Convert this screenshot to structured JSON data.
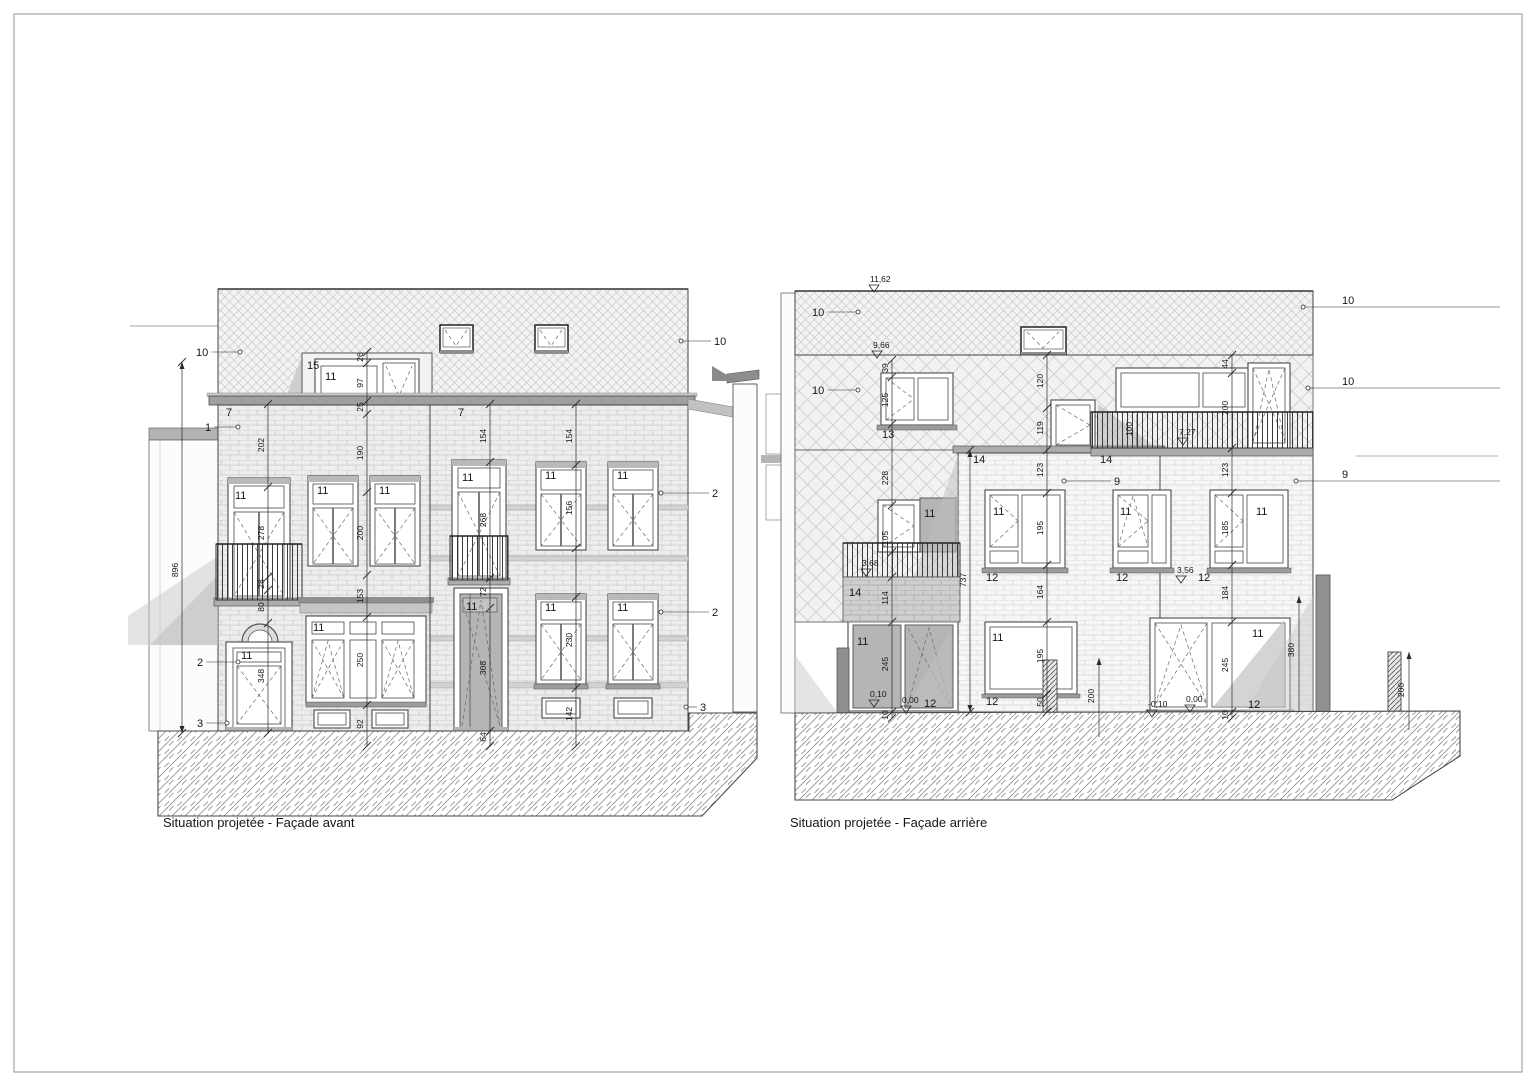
{
  "titles": {
    "front": "Situation projetée - Façade avant",
    "rear": "Situation projetée - Façade arrière"
  },
  "colors": {
    "ink": "#1a1a1a",
    "wall": "#ededed",
    "glass_tinted": "#b5b5b5",
    "shadow": "#c6c6c6"
  },
  "front": {
    "callouts": [
      {
        "t": "10",
        "tx": 196,
        "ty": 349,
        "dx": 240,
        "dy": 352
      },
      {
        "t": "10",
        "tx": 714,
        "ty": 337,
        "dx": 681,
        "dy": 341
      },
      {
        "t": "1",
        "tx": 205,
        "ty": 424,
        "dx": 238,
        "dy": 427
      },
      {
        "t": "2",
        "tx": 197,
        "ty": 659,
        "dx": 238,
        "dy": 662
      },
      {
        "t": "3",
        "tx": 197,
        "ty": 720,
        "dx": 227,
        "dy": 723
      },
      {
        "t": "2",
        "tx": 712,
        "ty": 489,
        "dx": 661,
        "dy": 493
      },
      {
        "t": "2",
        "tx": 712,
        "ty": 608,
        "dx": 661,
        "dy": 612
      },
      {
        "t": "3",
        "tx": 700,
        "ty": 703,
        "dx": 686,
        "dy": 707
      }
    ],
    "labels": [
      {
        "t": "7",
        "x": 226,
        "y": 416
      },
      {
        "t": "7",
        "x": 458,
        "y": 416
      },
      {
        "t": "15",
        "x": 307,
        "y": 369
      },
      {
        "t": "11",
        "x": 325,
        "y": 380
      },
      {
        "t": "11",
        "x": 235,
        "y": 499
      },
      {
        "t": "11",
        "x": 317,
        "y": 494
      },
      {
        "t": "11",
        "x": 379,
        "y": 494
      },
      {
        "t": "11",
        "x": 313,
        "y": 631
      },
      {
        "t": "11",
        "x": 241,
        "y": 659
      },
      {
        "t": "11",
        "x": 462,
        "y": 481
      },
      {
        "t": "11",
        "x": 466,
        "y": 610
      },
      {
        "t": "11",
        "x": 545,
        "y": 479
      },
      {
        "t": "11",
        "x": 617,
        "y": 479
      },
      {
        "t": "11",
        "x": 545,
        "y": 611
      },
      {
        "t": "11",
        "x": 617,
        "y": 611
      }
    ],
    "chains": [
      {
        "x": 182,
        "y1": 362,
        "y2": 733,
        "arrow": true,
        "ticks": [
          362,
          733
        ],
        "labels": [
          {
            "t": "896",
            "y": 570
          }
        ]
      },
      {
        "x": 268,
        "y1": 404,
        "y2": 733,
        "ticks": [
          404,
          487,
          577,
          590,
          623,
          733
        ],
        "labels": [
          {
            "t": "202",
            "y": 445
          },
          {
            "t": "278",
            "y": 533
          },
          {
            "t": "28",
            "y": 584
          },
          {
            "t": "80",
            "y": 607
          },
          {
            "t": "348",
            "y": 676
          }
        ]
      },
      {
        "x": 367,
        "y1": 352,
        "y2": 746,
        "ticks": [
          352,
          363,
          401,
          414,
          492,
          575,
          617,
          705,
          746
        ],
        "labels": [
          {
            "t": "26",
            "y": 357
          },
          {
            "t": "97",
            "y": 383
          },
          {
            "t": "25",
            "y": 407
          },
          {
            "t": "190",
            "y": 453
          },
          {
            "t": "200",
            "y": 533
          },
          {
            "t": "153",
            "y": 596
          },
          {
            "t": "250",
            "y": 660
          },
          {
            "t": "92",
            "y": 724
          }
        ]
      },
      {
        "x": 490,
        "y1": 404,
        "y2": 746,
        "ticks": [
          404,
          462,
          578,
          608,
          731,
          746
        ],
        "labels": [
          {
            "t": "154",
            "y": 436
          },
          {
            "t": "268",
            "y": 520
          },
          {
            "t": "72",
            "y": 592
          },
          {
            "t": "308",
            "y": 668
          },
          {
            "t": "64",
            "y": 737
          }
        ]
      },
      {
        "x": 576,
        "y1": 404,
        "y2": 746,
        "ticks": [
          404,
          465,
          548,
          597,
          688,
          746
        ],
        "labels": [
          {
            "t": "154",
            "y": 436
          },
          {
            "t": "156",
            "y": 508
          },
          {
            "t": "230",
            "y": 640
          },
          {
            "t": "142",
            "y": 714
          }
        ]
      }
    ]
  },
  "rear": {
    "callouts": [
      {
        "t": "10",
        "tx": 812,
        "ty": 308,
        "dx": 858,
        "dy": 312
      },
      {
        "t": "10",
        "tx": 812,
        "ty": 386,
        "dx": 858,
        "dy": 390
      },
      {
        "t": "10",
        "tx": 1342,
        "ty": 303,
        "dx": 1303,
        "dy": 307,
        "ext": 1500
      },
      {
        "t": "10",
        "tx": 1342,
        "ty": 384,
        "dx": 1308,
        "dy": 388,
        "ext": 1500
      },
      {
        "t": "9",
        "tx": 1114,
        "ty": 477,
        "dx": 1064,
        "dy": 481
      },
      {
        "t": "9",
        "tx": 1342,
        "ty": 477,
        "dx": 1296,
        "dy": 481,
        "ext": 1500
      }
    ],
    "labels": [
      {
        "t": "13",
        "x": 882,
        "y": 438
      },
      {
        "t": "14",
        "x": 973,
        "y": 463
      },
      {
        "t": "14",
        "x": 1100,
        "y": 463
      },
      {
        "t": "14",
        "x": 849,
        "y": 596
      },
      {
        "t": "11",
        "x": 924,
        "y": 517
      },
      {
        "t": "11",
        "x": 993,
        "y": 515
      },
      {
        "t": "11",
        "x": 992,
        "y": 641
      },
      {
        "t": "11",
        "x": 857,
        "y": 645
      },
      {
        "t": "11",
        "x": 1120,
        "y": 515
      },
      {
        "t": "11",
        "x": 1256,
        "y": 515
      },
      {
        "t": "11",
        "x": 1252,
        "y": 637
      },
      {
        "t": "12",
        "x": 986,
        "y": 581
      },
      {
        "t": "12",
        "x": 1116,
        "y": 581
      },
      {
        "t": "12",
        "x": 1198,
        "y": 581
      },
      {
        "t": "12",
        "x": 924,
        "y": 707
      },
      {
        "t": "12",
        "x": 986,
        "y": 705
      },
      {
        "t": "12",
        "x": 1248,
        "y": 708
      }
    ],
    "levels": [
      {
        "t": "11,62",
        "x": 874,
        "y": 285
      },
      {
        "t": "9,66",
        "x": 877,
        "y": 351
      },
      {
        "t": "7,27",
        "x": 1183,
        "y": 438
      },
      {
        "t": "3,68",
        "x": 866,
        "y": 569
      },
      {
        "t": "3,56",
        "x": 1181,
        "y": 576
      },
      {
        "t": "0,10",
        "x": 874,
        "y": 700
      },
      {
        "t": "0,00",
        "x": 906,
        "y": 706
      },
      {
        "t": "-0,10",
        "x": 1152,
        "y": 710
      },
      {
        "t": "0,00",
        "x": 1190,
        "y": 705
      }
    ],
    "texts": [
      {
        "t": "100",
        "x": 1132,
        "y": 429,
        "rot": 1
      },
      {
        "t": "200",
        "x": 1094,
        "y": 696,
        "rot": 1
      },
      {
        "t": "380",
        "x": 1294,
        "y": 650,
        "rot": 1
      },
      {
        "t": "200",
        "x": 1404,
        "y": 690,
        "rot": 1
      }
    ],
    "chains": [
      {
        "x": 892,
        "y1": 360,
        "y2": 718,
        "ticks": [
          360,
          377,
          424,
          505,
          552,
          577,
          622,
          712,
          718
        ],
        "labels": [
          {
            "t": "39",
            "y": 368
          },
          {
            "t": "125",
            "y": 400
          },
          {
            "t": "228",
            "y": 478
          },
          {
            "t": "105",
            "y": 538
          },
          {
            "t": "114",
            "y": 598
          },
          {
            "t": "245",
            "y": 664
          },
          {
            "t": "10",
            "y": 715
          }
        ]
      },
      {
        "x": 970,
        "y1": 450,
        "y2": 712,
        "arrow": true,
        "ticks": [
          450,
          712
        ],
        "labels": [
          {
            "t": "737",
            "y": 580
          }
        ]
      },
      {
        "x": 1047,
        "y1": 355,
        "y2": 712,
        "ticks": [
          355,
          408,
          450,
          493,
          565,
          622,
          694,
          712
        ],
        "labels": [
          {
            "t": "120",
            "y": 381
          },
          {
            "t": "119",
            "y": 428
          },
          {
            "t": "123",
            "y": 470
          },
          {
            "t": "195",
            "y": 528
          },
          {
            "t": "164",
            "y": 592
          },
          {
            "t": "195",
            "y": 656
          },
          {
            "t": "50",
            "y": 702
          }
        ]
      },
      {
        "x": 1232,
        "y1": 355,
        "y2": 718,
        "ticks": [
          355,
          373,
          448,
          493,
          565,
          622,
          712,
          718
        ],
        "labels": [
          {
            "t": "44",
            "y": 364
          },
          {
            "t": "200",
            "y": 408
          },
          {
            "t": "123",
            "y": 470
          },
          {
            "t": "185",
            "y": 528
          },
          {
            "t": "184",
            "y": 593
          },
          {
            "t": "245",
            "y": 665
          },
          {
            "t": "10",
            "y": 715
          }
        ]
      }
    ]
  }
}
